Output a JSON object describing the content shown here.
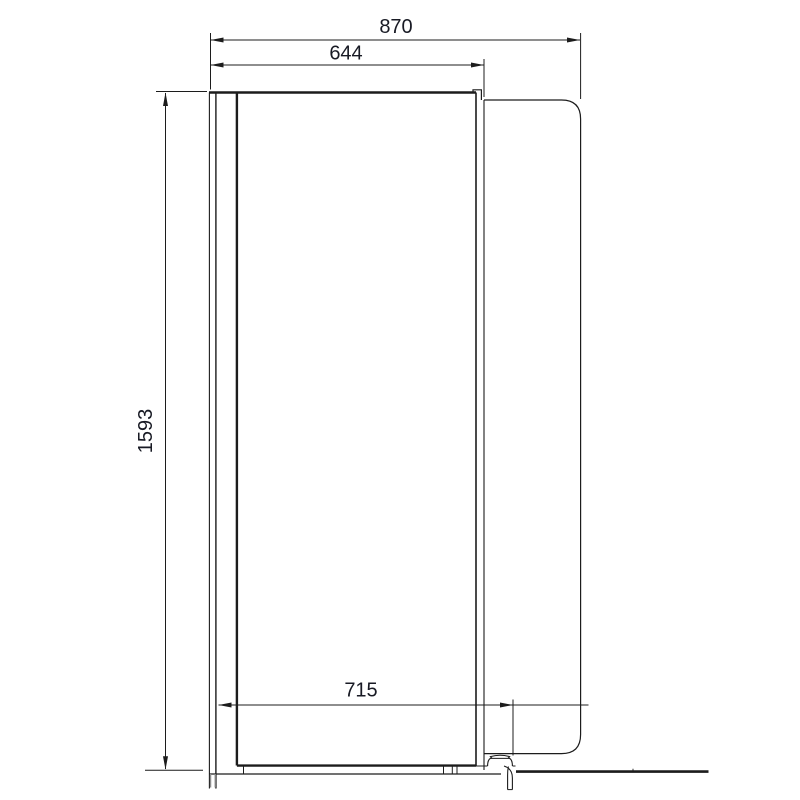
{
  "canvas": {
    "background": "#ffffff",
    "line_color": "#1c1c1c",
    "text_color": "#181a24"
  },
  "drawing": {
    "kind": "side-elevation dimension drawing of appliance cabinet with door panel, rear foot and floor line"
  },
  "dimensions": {
    "overall_depth": "870",
    "body_depth": "644",
    "overall_height": "1593",
    "base_depth": "715"
  }
}
